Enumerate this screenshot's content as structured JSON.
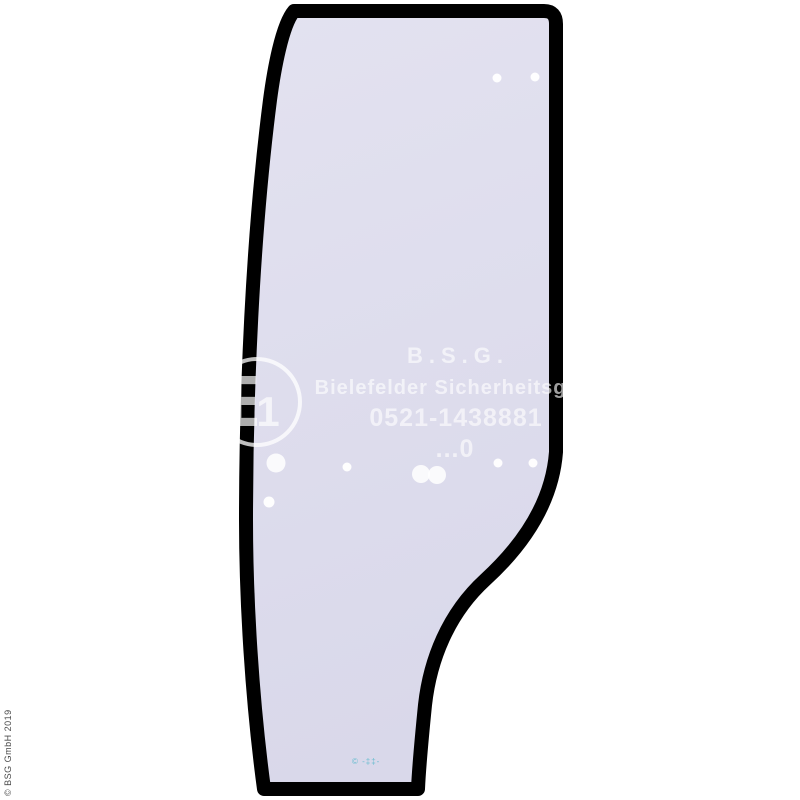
{
  "page": {
    "width": 800,
    "height": 800,
    "background": "#ffffff"
  },
  "watermark": {
    "line1": "B.S.G.",
    "line2": "Bielefelder Sicherheitsglas",
    "line3": "0521-1438881",
    "line4": "...0",
    "approval_mark_letter": "E",
    "approval_mark_number": "1"
  },
  "footer": {
    "copyright_vertical": "© BSG GmbH 2019",
    "stamp_mark": "© -‡‡-"
  },
  "colors": {
    "page_bg": "#ffffff",
    "border_color": "#000000",
    "glass_fill_top": "#e3e2f0",
    "glass_fill_bottom": "#d9d8ea",
    "watermark_color": "#ffffff",
    "copyright_color": "#4a4a4a",
    "stamp_color": "#55b8cb"
  },
  "glass": {
    "dots": [
      {
        "x": 497,
        "y": 78,
        "r": 4.5
      },
      {
        "x": 535,
        "y": 77,
        "r": 4.5
      },
      {
        "x": 276,
        "y": 463,
        "r": 9.5
      },
      {
        "x": 269,
        "y": 502,
        "r": 5.5
      },
      {
        "x": 347,
        "y": 467,
        "r": 4.5
      },
      {
        "x": 421,
        "y": 474,
        "r": 9
      },
      {
        "x": 437,
        "y": 475,
        "r": 9
      },
      {
        "x": 498,
        "y": 463,
        "r": 4.5
      },
      {
        "x": 533,
        "y": 463,
        "r": 4.5
      }
    ]
  }
}
